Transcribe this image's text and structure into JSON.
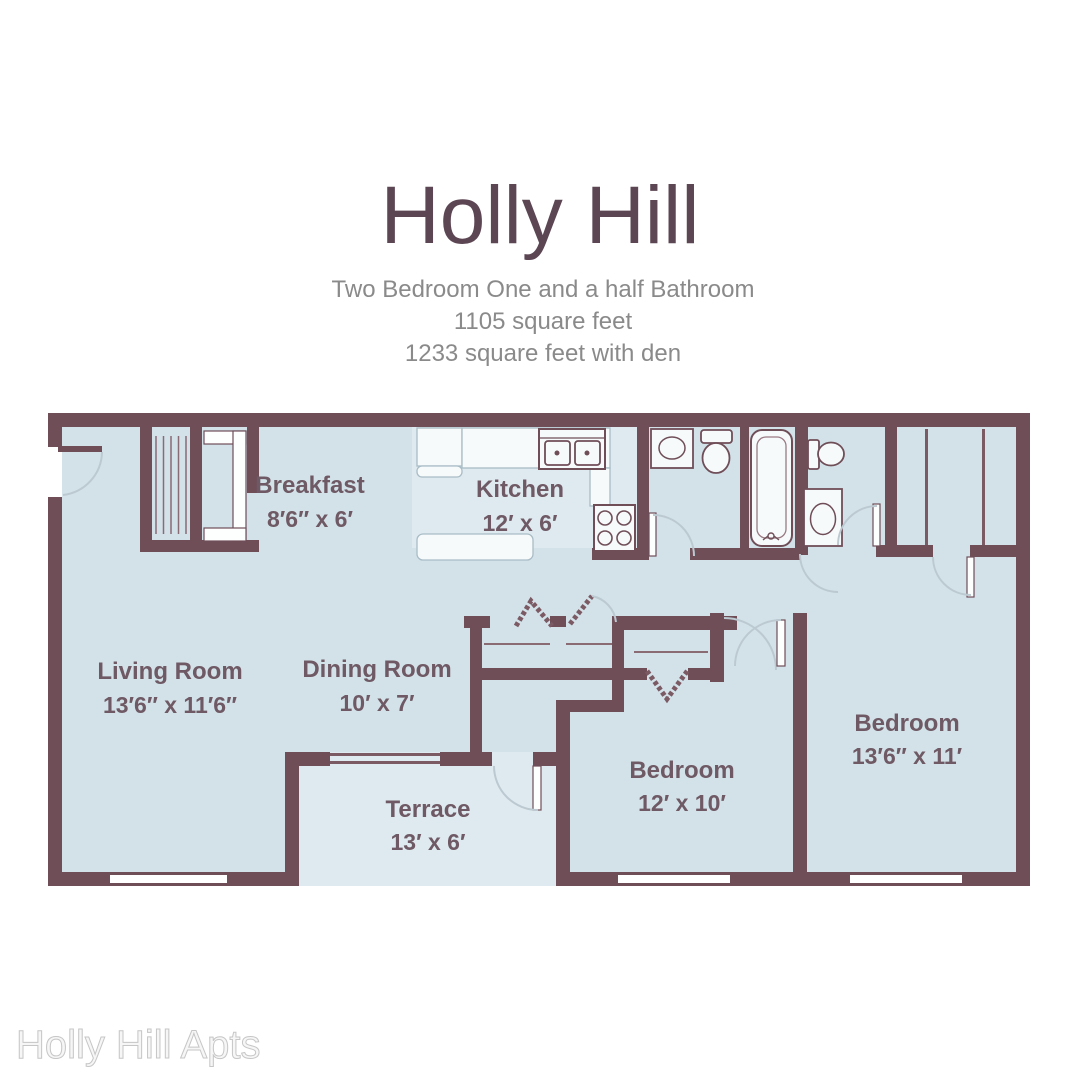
{
  "title": "Holly Hill",
  "subtitle": {
    "line1": "Two Bedroom One and a half Bathroom",
    "line2": "1105 square feet",
    "line3": "1233 square feet with den"
  },
  "watermark": "Holly Hill Apts",
  "colors": {
    "wall": "#6F4E58",
    "floor": "#D3E2E9",
    "floor_light": "#DFEAF0",
    "room_label": "#6E5964",
    "title": "#5C4653",
    "subtitle": "#8A8A8A",
    "watermark": "#E4E4E4",
    "door_arc": "#BCC9D1"
  },
  "rooms": [
    {
      "name": "Breakfast",
      "dimensions": "8′6″ x 6′"
    },
    {
      "name": "Kitchen",
      "dimensions": "12′ x 6′"
    },
    {
      "name": "Living Room",
      "dimensions": "13′6″ x 11′6″"
    },
    {
      "name": "Dining Room",
      "dimensions": "10′ x 7′"
    },
    {
      "name": "Terrace",
      "dimensions": "13′ x 6′"
    },
    {
      "name": "Bedroom",
      "dimensions": "12′ x 10′"
    },
    {
      "name": "Bedroom",
      "dimensions": "13′6″ x 11′"
    }
  ]
}
